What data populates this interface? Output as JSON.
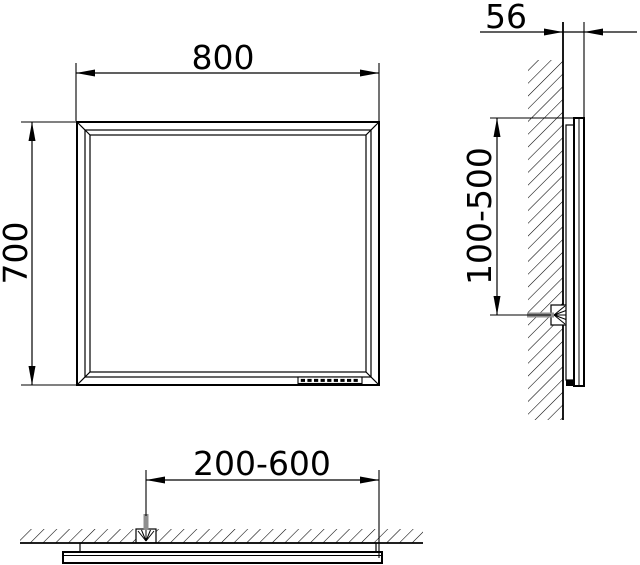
{
  "drawing": {
    "type": "technical-installation-drawing",
    "views": {
      "front": "front-view",
      "side": "side-section-view",
      "bottom": "bottom-plan-view"
    }
  },
  "dimensions": {
    "front_width": "800",
    "front_height": "700",
    "side_depth": "56",
    "side_mounting_range": "100-500",
    "bottom_mounting_range": "200-600"
  },
  "colors": {
    "line": "#000000",
    "screw_gray": "#8f8f8f",
    "background": "#ffffff"
  },
  "icons": {
    "wall_anchor": "anchor-starburst-icon",
    "sensor_strip": "button-row-icon",
    "hatching": "wall-hatch-pattern"
  }
}
